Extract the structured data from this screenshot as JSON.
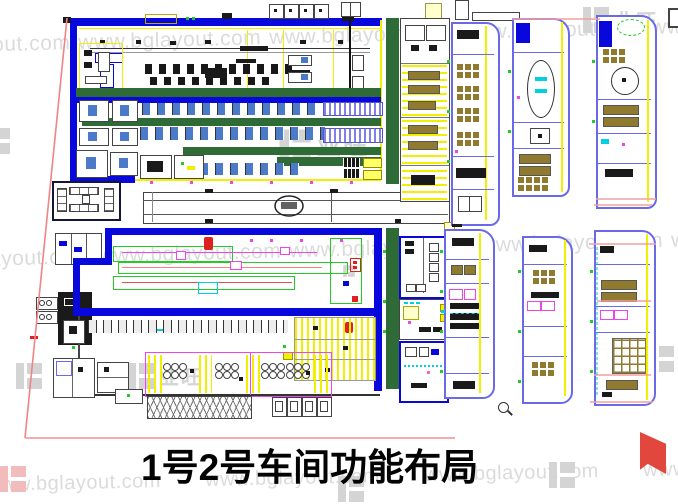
{
  "caption": {
    "text": "1号2号车间功能布局"
  },
  "watermark": {
    "url_text": "www.bglayout.com",
    "logo_text": "业旺"
  },
  "colors": {
    "cad_blue": "#0808dd",
    "cad_green": "#2f6b36",
    "cad_yellow": "#f0f000",
    "cad_purple": "#6a6ae8",
    "cad_magenta": "#ee44ee",
    "cad_cyan": "#00d0e0",
    "cad_red": "#e02020",
    "leader_red": "#ef8585",
    "pink_line": "#f2a0a0",
    "desk_brown": "#8f7a30",
    "machine_blue": "#4a7ac8",
    "watermark_gray": "#dbdbdb",
    "title_black": "#030303"
  }
}
